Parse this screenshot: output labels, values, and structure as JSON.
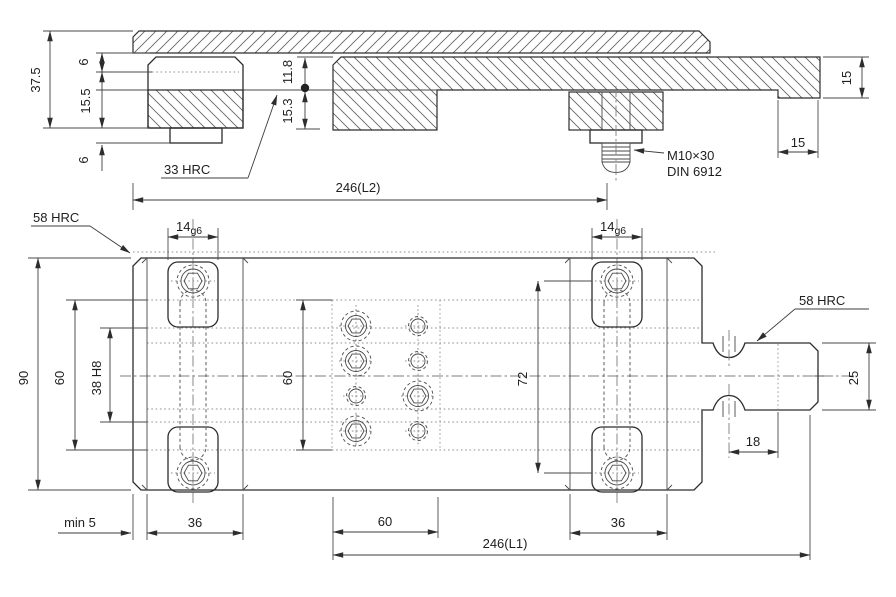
{
  "drawing": {
    "labels": {
      "hardness_jaw": "33 HRC",
      "hardness_body": "58 HRC",
      "hardness_tongue": "58 HRC",
      "screw_spec_line1": "M10×30",
      "screw_spec_line2": "DIN 6912"
    },
    "dims": {
      "total_height": "37.5",
      "jaw_top_offset": "6",
      "jaw_lower_height": "15.5",
      "base_gap": "6",
      "rail_upper": "11.8",
      "rail_lower": "15.3",
      "overall_length_top": "246(L2)",
      "end_thickness": "15",
      "end_step_width": "15",
      "tslot_width": "14",
      "tslot_fit": "g6",
      "body_width": "90",
      "groove_span": "60",
      "center_groove": "38 H8",
      "hole_field_height": "60",
      "screw_spacing": "72",
      "tongue_width": "25",
      "relief_offset": "18",
      "min_clearance": "min 5",
      "pad_width": "36",
      "hole_field_length": "60",
      "overall_length_bottom": "246(L1)"
    }
  }
}
